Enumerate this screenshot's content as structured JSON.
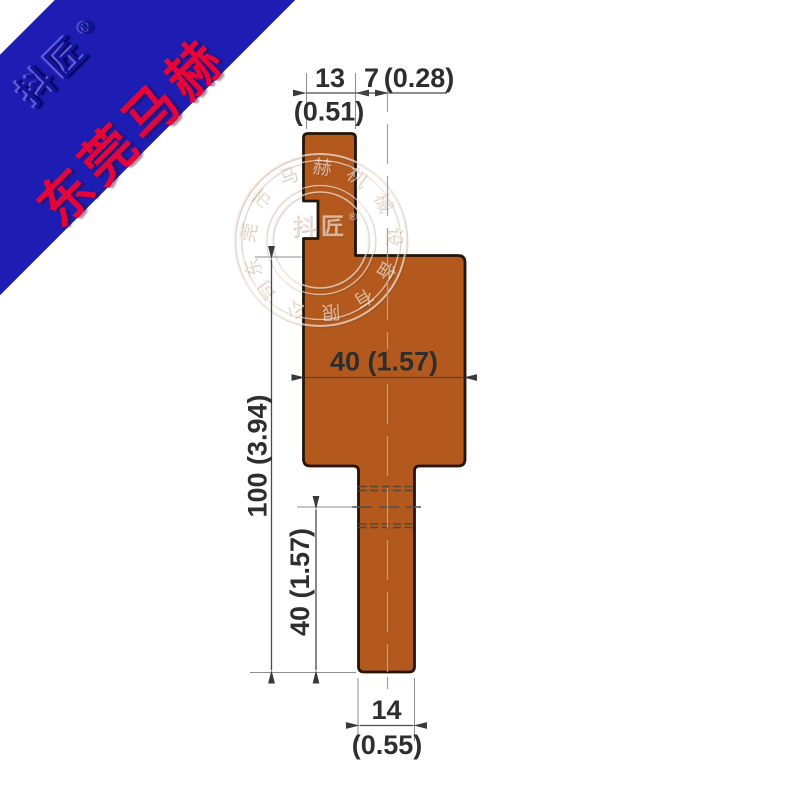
{
  "ribbon": {
    "logo_text": "抖匠",
    "registered_mark": "®",
    "brand_text": "东莞马赫"
  },
  "drawing": {
    "title": "press-brake punch profile",
    "dimensions": {
      "tang_width_mm": "13",
      "tang_width_in": "(0.51)",
      "center_offset_mm": "7",
      "center_offset_in": "(0.28)",
      "body_width": "40 (1.57)",
      "overall_height": "100 (3.94)",
      "lower_section_height": "40 (1.57)",
      "tip_width_mm": "14",
      "tip_width_in": "(0.55)"
    },
    "colors": {
      "tool_fill": "#b3591d",
      "tool_outline": "#241508",
      "dim_line": "#4a4a4a",
      "dim_text": "#2e2e2e",
      "banner_blue": "#1d1db4",
      "brand_red": "#e60538"
    }
  },
  "watermark": {
    "ring_text": "东莞市马赫机械设备有限公司",
    "center_text": "抖匠",
    "registered_mark": "®"
  }
}
